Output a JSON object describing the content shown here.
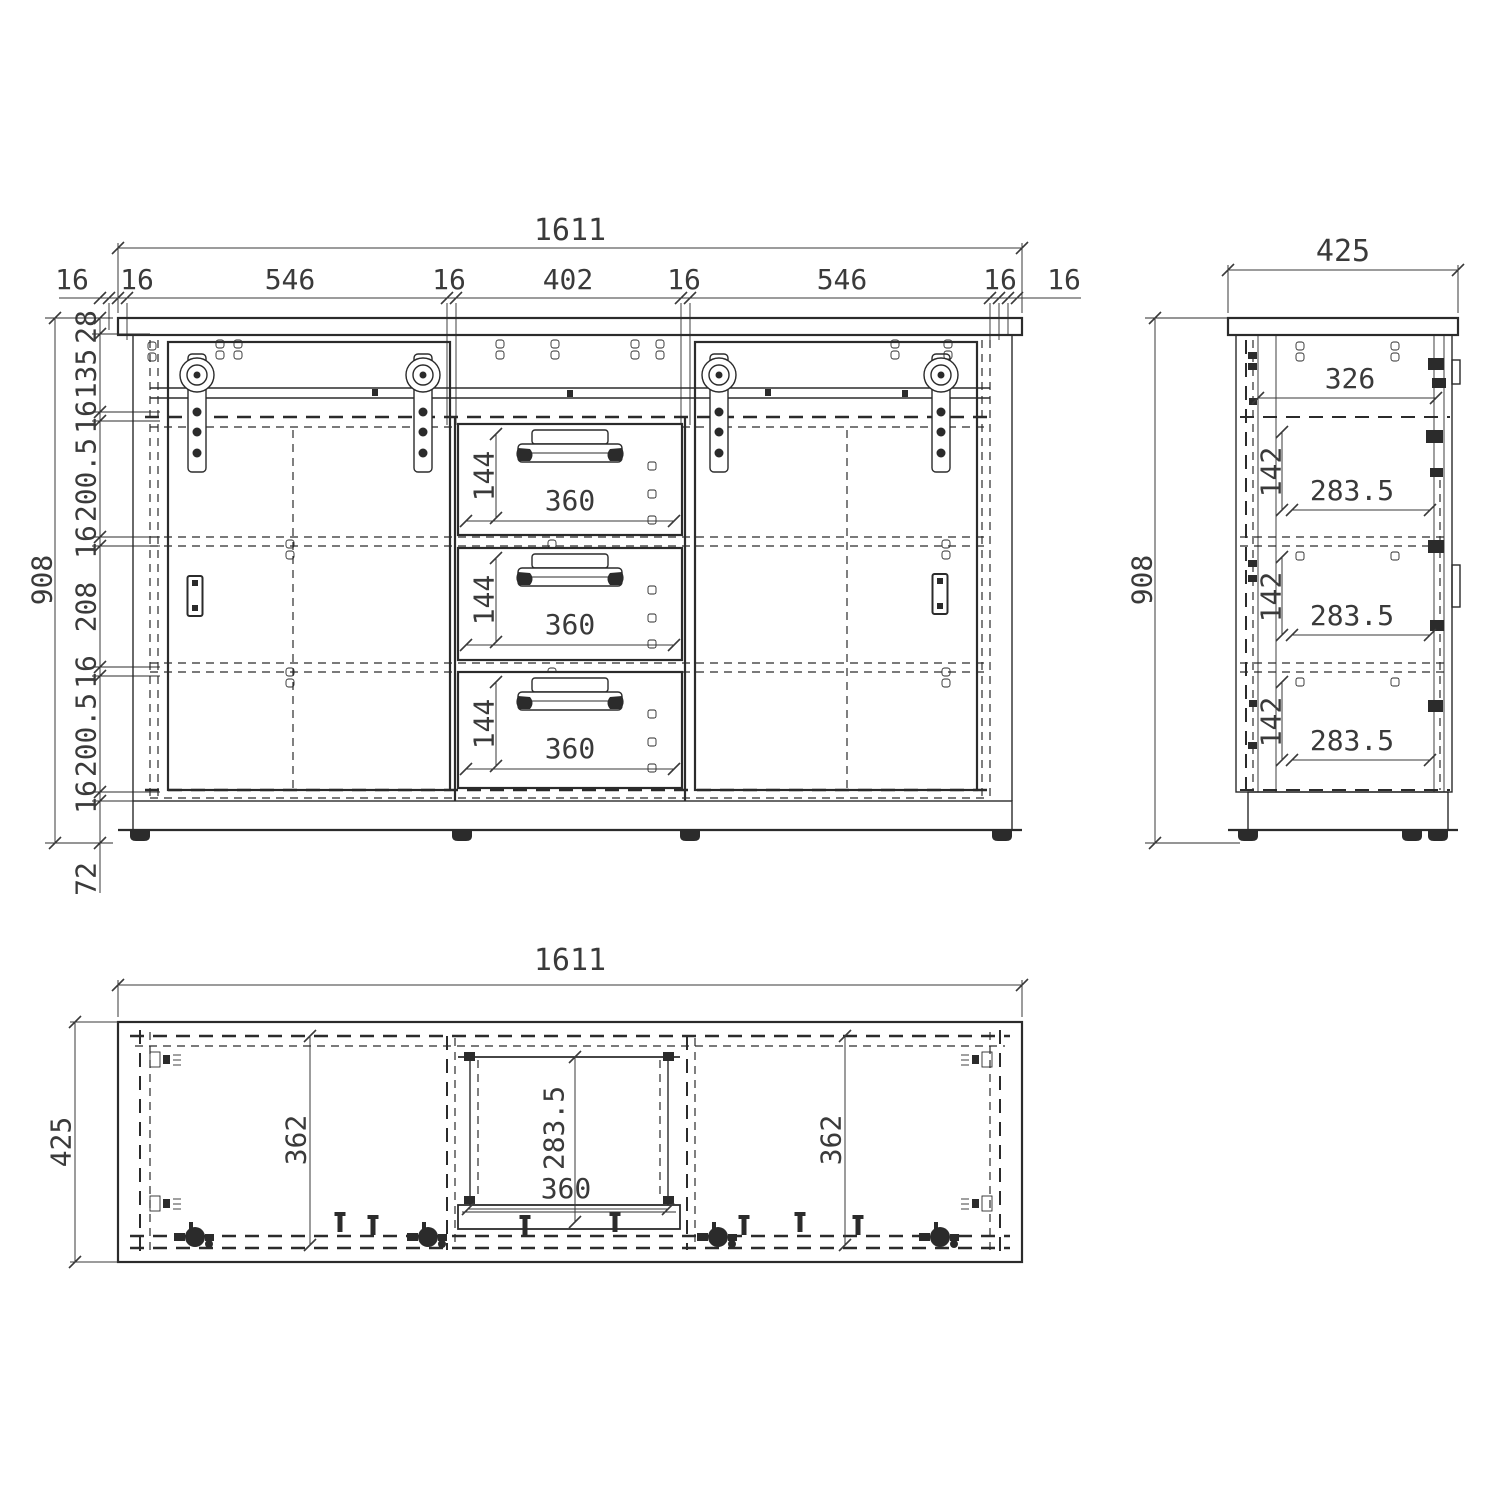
{
  "front": {
    "overall_width": "1611",
    "overall_height": "908",
    "plinth_height": "72",
    "width_chain": [
      "16",
      "16",
      "546",
      "16",
      "402",
      "16",
      "546",
      "16",
      "16"
    ],
    "height_chain": [
      "28",
      "135",
      "16",
      "200.5",
      "16",
      "208",
      "16",
      "200.5",
      "16"
    ],
    "drawer_widths": [
      "360",
      "360",
      "360"
    ],
    "drawer_heights": [
      "144",
      "144",
      "144"
    ]
  },
  "side": {
    "overall_depth": "425",
    "overall_height": "908",
    "top_inner_depth": "326",
    "shelf_depths": [
      "283.5",
      "283.5",
      "283.5"
    ],
    "shelf_heights": [
      "142",
      "142",
      "142"
    ]
  },
  "plan": {
    "overall_width": "1611",
    "overall_depth": "425",
    "left_door_width": "362",
    "right_door_width": "362",
    "drawer_depth": "283.5",
    "drawer_width": "360"
  }
}
